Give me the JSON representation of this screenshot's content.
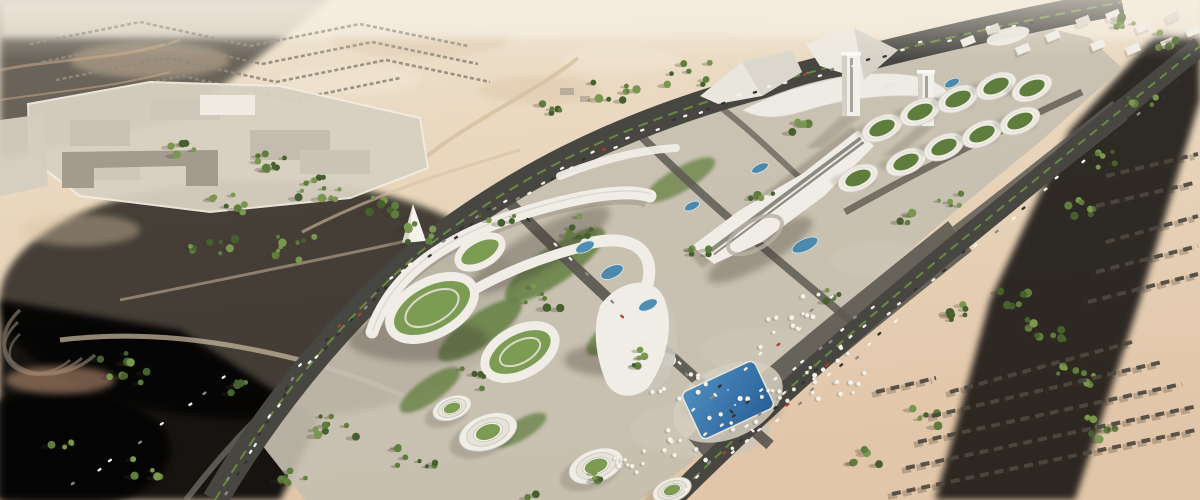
{
  "meta": {
    "description": "Aerial architectural rendering of a large mixed-use desert development: white terraced buildings with green roofs, twin towers on a podium, oval green-roof pavilions, a blue swimming pool, curving highways with traffic, palm and tree clusters, distant suburban housing grids and bare pink desert sand.",
    "image_type": "architectural-visualization",
    "visible_text": "none"
  },
  "palette": {
    "sand_pale": "#eee3d0",
    "sand_light": "#e8d5bb",
    "sand_mid": "#dfc2a4",
    "sand_pink": "#dcae90",
    "sand_deep": "#c89a7b",
    "haze": "#f3ebdc",
    "road_dark": "#474641",
    "road_mid": "#5d5a53",
    "road_light": "#8a867c",
    "pavement": "#c6bfb0",
    "pavement_dark": "#a59d8e",
    "bldg_white": "#efede6",
    "bldg_shade": "#c9c5ba",
    "roof_dark": "#827f76",
    "green_dark": "#47602f",
    "green_mid": "#5f7d3c",
    "green_light": "#7a974f",
    "lawn": "#7c9c53",
    "pool_blue": "#2d6ca5",
    "pool_light": "#4f8ec0",
    "teal": "#3e84ad",
    "median": "#6d9040",
    "car_white": "#f4f3ef",
    "car_dark": "#34332f",
    "car_gray": "#8e8b83",
    "car_red": "#a8402e",
    "row_dark": "#4c4840",
    "row_far": "#8f897b",
    "shadow": "rgba(62,52,36,0.32)"
  },
  "scene": {
    "regions": [
      "desert terrain with pink and beige sand",
      "distant suburban housing grid (top left)",
      "walled industrial compound (top left)",
      "hairpin terraced track (far left)",
      "curving left highway with traffic and green median",
      "central parcel of white curved terraced buildings with landscaped courtyards",
      "cone-shaped landmark pavilion",
      "sail-shaped central building",
      "stepped oval terrace buildings with lawn roofs",
      "blue swimming pool with deck",
      "umbrella plaza and surface parking",
      "twin white towers on elongated podium",
      "grid of oval green-roof pavilions",
      "right arterial road with parking lanes",
      "bare pink construction strip",
      "rows of housing under construction (bottom right)",
      "distant white district (top right)"
    ]
  },
  "generated": {
    "tree_clusters": [
      {
        "x": 265,
        "y": 162,
        "n": 9,
        "s": 40
      },
      {
        "x": 322,
        "y": 188,
        "n": 11,
        "s": 48
      },
      {
        "x": 228,
        "y": 204,
        "n": 7,
        "s": 34
      },
      {
        "x": 388,
        "y": 204,
        "n": 7,
        "s": 38
      },
      {
        "x": 182,
        "y": 148,
        "n": 5,
        "s": 24
      },
      {
        "x": 212,
        "y": 248,
        "n": 8,
        "s": 52
      },
      {
        "x": 300,
        "y": 252,
        "n": 9,
        "s": 56
      },
      {
        "x": 424,
        "y": 232,
        "n": 7,
        "s": 44
      },
      {
        "x": 498,
        "y": 220,
        "n": 5,
        "s": 36
      },
      {
        "x": 615,
        "y": 95,
        "n": 7,
        "s": 48
      },
      {
        "x": 688,
        "y": 74,
        "n": 7,
        "s": 44
      },
      {
        "x": 552,
        "y": 112,
        "n": 5,
        "s": 34
      },
      {
        "x": 130,
        "y": 368,
        "n": 9,
        "s": 60
      },
      {
        "x": 332,
        "y": 428,
        "n": 9,
        "s": 56
      },
      {
        "x": 420,
        "y": 458,
        "n": 8,
        "s": 50
      },
      {
        "x": 292,
        "y": 478,
        "n": 6,
        "s": 42
      },
      {
        "x": 152,
        "y": 468,
        "n": 5,
        "s": 38
      },
      {
        "x": 62,
        "y": 440,
        "n": 4,
        "s": 28
      },
      {
        "x": 242,
        "y": 388,
        "n": 5,
        "s": 28
      },
      {
        "x": 1046,
        "y": 330,
        "n": 9,
        "s": 42
      },
      {
        "x": 1076,
        "y": 378,
        "n": 8,
        "s": 42
      },
      {
        "x": 1012,
        "y": 300,
        "n": 7,
        "s": 34
      },
      {
        "x": 1098,
        "y": 428,
        "n": 7,
        "s": 42
      },
      {
        "x": 952,
        "y": 310,
        "n": 6,
        "s": 38
      },
      {
        "x": 1076,
        "y": 210,
        "n": 7,
        "s": 38
      },
      {
        "x": 1110,
        "y": 160,
        "n": 6,
        "s": 34
      },
      {
        "x": 1142,
        "y": 100,
        "n": 5,
        "s": 28
      },
      {
        "x": 1162,
        "y": 40,
        "n": 5,
        "s": 32
      },
      {
        "x": 1120,
        "y": 24,
        "n": 5,
        "s": 28
      },
      {
        "x": 592,
        "y": 228,
        "n": 6,
        "s": 46
      },
      {
        "x": 540,
        "y": 298,
        "n": 6,
        "s": 42
      },
      {
        "x": 642,
        "y": 358,
        "n": 5,
        "s": 34
      },
      {
        "x": 470,
        "y": 378,
        "n": 5,
        "s": 38
      },
      {
        "x": 702,
        "y": 248,
        "n": 5,
        "s": 36
      },
      {
        "x": 762,
        "y": 198,
        "n": 4,
        "s": 28
      },
      {
        "x": 832,
        "y": 298,
        "n": 4,
        "s": 28
      },
      {
        "x": 902,
        "y": 218,
        "n": 4,
        "s": 24
      },
      {
        "x": 802,
        "y": 128,
        "n": 4,
        "s": 24
      },
      {
        "x": 952,
        "y": 198,
        "n": 5,
        "s": 28
      },
      {
        "x": 862,
        "y": 458,
        "n": 5,
        "s": 34
      },
      {
        "x": 922,
        "y": 418,
        "n": 5,
        "s": 34
      },
      {
        "x": 600,
        "y": 480,
        "n": 4,
        "s": 26
      },
      {
        "x": 530,
        "y": 500,
        "n": 3,
        "s": 22
      }
    ],
    "car_lanes": [
      {
        "x1": 222,
        "y1": 495,
        "x2": 298,
        "y2": 372,
        "n": 13
      },
      {
        "x1": 298,
        "y1": 372,
        "x2": 388,
        "y2": 282,
        "n": 13
      },
      {
        "x1": 388,
        "y1": 282,
        "x2": 492,
        "y2": 210,
        "n": 12
      },
      {
        "x1": 492,
        "y1": 210,
        "x2": 610,
        "y2": 146,
        "n": 11
      },
      {
        "x1": 610,
        "y1": 146,
        "x2": 745,
        "y2": 95,
        "n": 10
      },
      {
        "x1": 745,
        "y1": 95,
        "x2": 890,
        "y2": 52,
        "n": 9
      },
      {
        "x1": 890,
        "y1": 52,
        "x2": 1040,
        "y2": 18,
        "n": 7
      },
      {
        "x1": 680,
        "y1": 492,
        "x2": 780,
        "y2": 400,
        "n": 8
      },
      {
        "x1": 780,
        "y1": 400,
        "x2": 890,
        "y2": 308,
        "n": 8
      },
      {
        "x1": 890,
        "y1": 308,
        "x2": 1000,
        "y2": 226,
        "n": 7
      },
      {
        "x1": 1000,
        "y1": 226,
        "x2": 1105,
        "y2": 142,
        "n": 6
      },
      {
        "x1": 1105,
        "y1": 142,
        "x2": 1190,
        "y2": 72,
        "n": 4
      },
      {
        "x1": 520,
        "y1": 212,
        "x2": 640,
        "y2": 330,
        "n": 6
      },
      {
        "x1": 640,
        "y1": 330,
        "x2": 766,
        "y2": 446,
        "n": 6
      },
      {
        "x1": 700,
        "y1": 440,
        "x2": 880,
        "y2": 300,
        "n": 13
      },
      {
        "x1": 726,
        "y1": 458,
        "x2": 902,
        "y2": 318,
        "n": 13
      },
      {
        "x1": 680,
        "y1": 420,
        "x2": 840,
        "y2": 292,
        "n": 9
      },
      {
        "x1": 60,
        "y1": 496,
        "x2": 150,
        "y2": 432,
        "n": 4
      },
      {
        "x1": 150,
        "y1": 432,
        "x2": 240,
        "y2": 370,
        "n": 4
      }
    ],
    "housing_rows_far": [
      {
        "x1": 30,
        "y1": 44,
        "x2": 140,
        "y2": 22
      },
      {
        "x1": 140,
        "y1": 22,
        "x2": 250,
        "y2": 46
      },
      {
        "x1": 250,
        "y1": 46,
        "x2": 360,
        "y2": 24
      },
      {
        "x1": 360,
        "y1": 24,
        "x2": 468,
        "y2": 46
      },
      {
        "x1": 42,
        "y1": 62,
        "x2": 152,
        "y2": 40
      },
      {
        "x1": 152,
        "y1": 40,
        "x2": 262,
        "y2": 64
      },
      {
        "x1": 262,
        "y1": 64,
        "x2": 372,
        "y2": 42
      },
      {
        "x1": 372,
        "y1": 42,
        "x2": 478,
        "y2": 64
      },
      {
        "x1": 56,
        "y1": 80,
        "x2": 166,
        "y2": 58
      },
      {
        "x1": 166,
        "y1": 58,
        "x2": 276,
        "y2": 82
      },
      {
        "x1": 276,
        "y1": 82,
        "x2": 386,
        "y2": 60
      },
      {
        "x1": 386,
        "y1": 60,
        "x2": 490,
        "y2": 82
      },
      {
        "x1": 72,
        "y1": 98,
        "x2": 182,
        "y2": 76
      },
      {
        "x1": 182,
        "y1": 76,
        "x2": 292,
        "y2": 100
      },
      {
        "x1": 292,
        "y1": 100,
        "x2": 400,
        "y2": 78
      }
    ],
    "housing_rows_near": [
      {
        "x1": 892,
        "y1": 494,
        "x2": 1196,
        "y2": 430
      },
      {
        "x1": 906,
        "y1": 468,
        "x2": 1198,
        "y2": 406
      },
      {
        "x1": 918,
        "y1": 442,
        "x2": 1182,
        "y2": 384
      },
      {
        "x1": 932,
        "y1": 416,
        "x2": 1162,
        "y2": 362
      },
      {
        "x1": 950,
        "y1": 392,
        "x2": 1132,
        "y2": 342
      },
      {
        "x1": 1088,
        "y1": 302,
        "x2": 1198,
        "y2": 274
      },
      {
        "x1": 1096,
        "y1": 272,
        "x2": 1198,
        "y2": 246
      },
      {
        "x1": 1106,
        "y1": 242,
        "x2": 1198,
        "y2": 216
      },
      {
        "x1": 1096,
        "y1": 206,
        "x2": 1198,
        "y2": 182
      },
      {
        "x1": 1106,
        "y1": 176,
        "x2": 1198,
        "y2": 154
      },
      {
        "x1": 876,
        "y1": 392,
        "x2": 936,
        "y2": 378
      }
    ],
    "umbrella_zones": [
      {
        "x": 660,
        "y": 430,
        "ux": 180,
        "uy": -85,
        "vx": 40,
        "vy": 40,
        "n": 38
      },
      {
        "x": 648,
        "y": 390,
        "ux": 48,
        "uy": -26,
        "vx": 16,
        "vy": 24,
        "n": 9
      },
      {
        "x": 740,
        "y": 330,
        "ux": 88,
        "uy": -52,
        "vx": 18,
        "vy": 22,
        "n": 12
      },
      {
        "x": 612,
        "y": 458,
        "ux": 66,
        "uy": -24,
        "vx": 16,
        "vy": 20,
        "n": 12
      }
    ],
    "oval_buildings": [
      {
        "x": 882,
        "y": 128
      },
      {
        "x": 920,
        "y": 112
      },
      {
        "x": 958,
        "y": 99
      },
      {
        "x": 996,
        "y": 86
      },
      {
        "x": 906,
        "y": 162
      },
      {
        "x": 944,
        "y": 147
      },
      {
        "x": 982,
        "y": 134
      },
      {
        "x": 1020,
        "y": 121
      },
      {
        "x": 858,
        "y": 178
      },
      {
        "x": 1032,
        "y": 88
      }
    ],
    "stepped_buildings": [
      {
        "x": 488,
        "y": 432,
        "r": 30
      },
      {
        "x": 596,
        "y": 466,
        "r": 28
      },
      {
        "x": 672,
        "y": 490,
        "r": 20
      },
      {
        "x": 452,
        "y": 408,
        "r": 20
      }
    ],
    "water_features": [
      {
        "x": 585,
        "y": 247,
        "rx": 10,
        "ry": 5
      },
      {
        "x": 612,
        "y": 272,
        "rx": 12,
        "ry": 6
      },
      {
        "x": 648,
        "y": 305,
        "rx": 10,
        "ry": 5
      },
      {
        "x": 805,
        "y": 245,
        "rx": 14,
        "ry": 6
      },
      {
        "x": 760,
        "y": 168,
        "rx": 9,
        "ry": 4
      },
      {
        "x": 692,
        "y": 206,
        "rx": 8,
        "ry": 4
      },
      {
        "x": 890,
        "y": 86,
        "rx": 9,
        "ry": 4
      },
      {
        "x": 952,
        "y": 83,
        "rx": 8,
        "ry": 4
      },
      {
        "x": 900,
        "y": 120,
        "rx": 7,
        "ry": 4
      }
    ],
    "district_boxes": [
      {
        "x": 1075,
        "y": 20
      },
      {
        "x": 1105,
        "y": 14
      },
      {
        "x": 1135,
        "y": 26
      },
      {
        "x": 1165,
        "y": 16
      },
      {
        "x": 1090,
        "y": 44
      },
      {
        "x": 1125,
        "y": 48
      },
      {
        "x": 1160,
        "y": 42
      },
      {
        "x": 1185,
        "y": 30
      },
      {
        "x": 960,
        "y": 40
      },
      {
        "x": 985,
        "y": 28
      },
      {
        "x": 1015,
        "y": 48
      },
      {
        "x": 1045,
        "y": 35
      }
    ]
  }
}
